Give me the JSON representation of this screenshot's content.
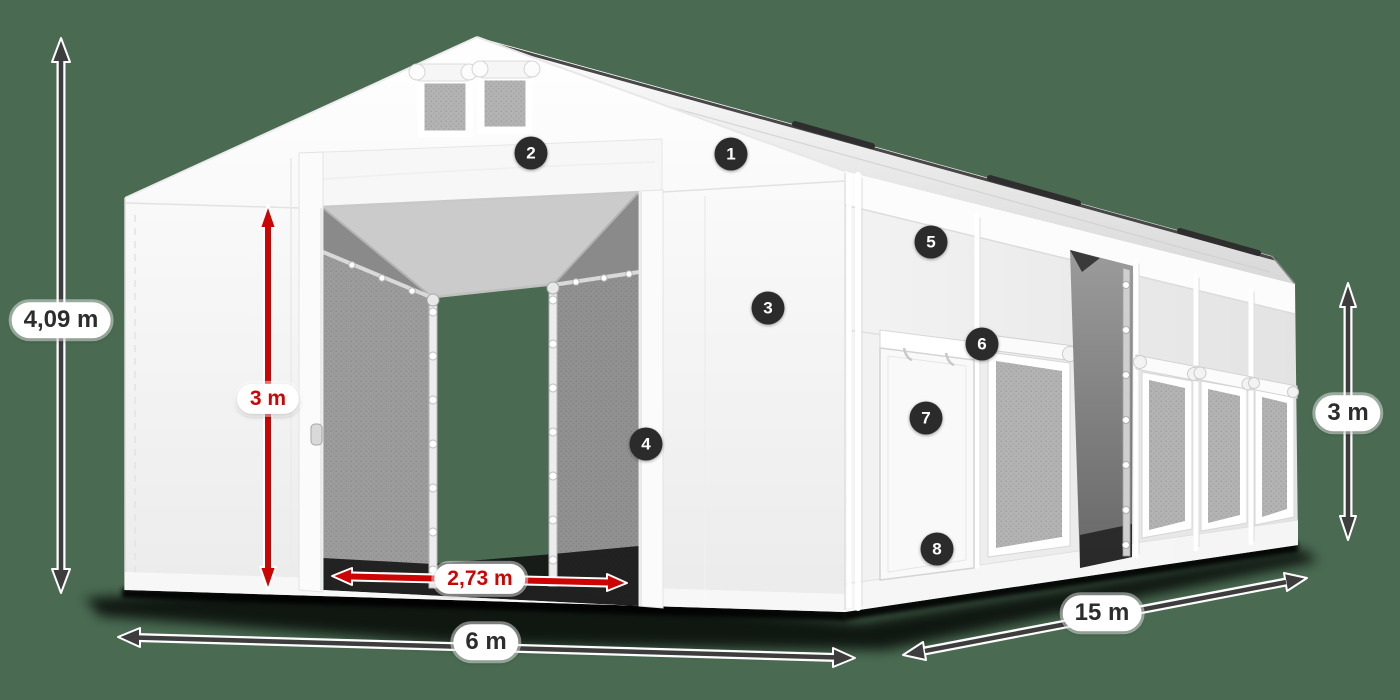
{
  "title": "Storage tent dimension diagram",
  "colors": {
    "background": "#4a6b52",
    "arrow_dark": "#3d3d3d",
    "arrow_red": "#cc0404",
    "badge_background": "#2b2b2b",
    "badge_text": "#ffffff",
    "label_background": "#ffffff",
    "label_text": "#2d2d2d"
  },
  "dimensions": {
    "total_height": {
      "label": "4,09 m"
    },
    "entrance_height": {
      "label": "3 m"
    },
    "entrance_width": {
      "label": "2,73 m"
    },
    "width": {
      "label": "6 m"
    },
    "length": {
      "label": "15 m"
    },
    "side_height": {
      "label": "3 m"
    }
  },
  "badges": [
    {
      "number": "1"
    },
    {
      "number": "2"
    },
    {
      "number": "3"
    },
    {
      "number": "4"
    },
    {
      "number": "5"
    },
    {
      "number": "6"
    },
    {
      "number": "7"
    },
    {
      "number": "8"
    }
  ]
}
